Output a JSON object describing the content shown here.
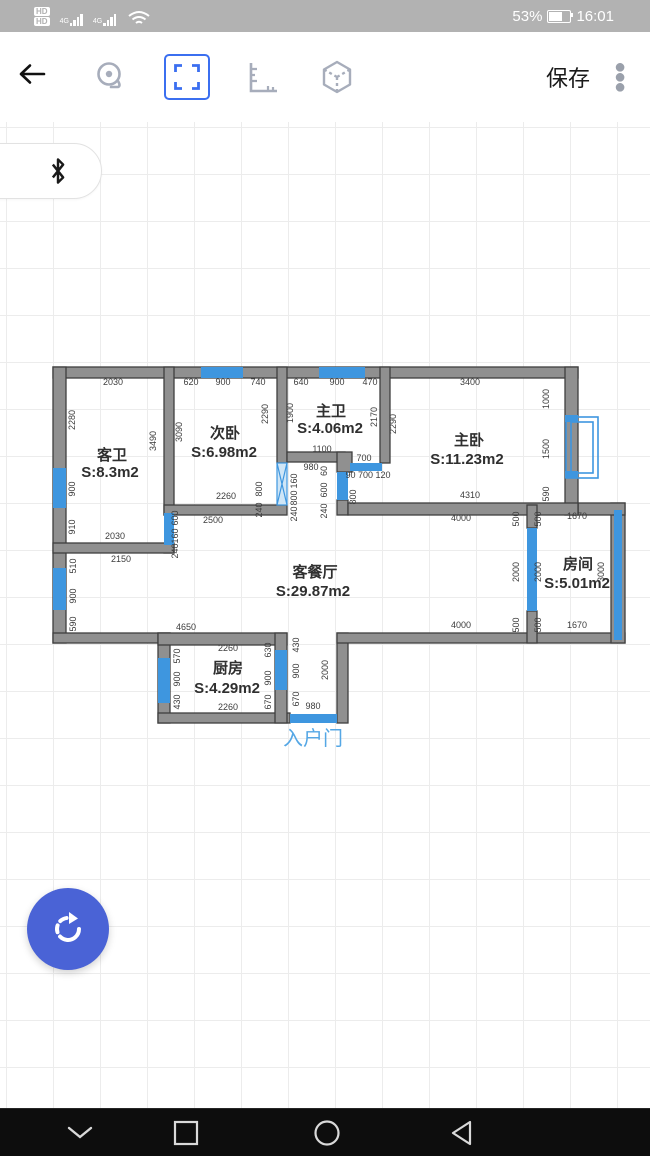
{
  "status_bar": {
    "hd_labels": [
      "HD",
      "HD"
    ],
    "network_label": "4G",
    "battery_percent": "53%",
    "time": "16:01"
  },
  "toolbar": {
    "back_icon": "arrow-left",
    "icons": [
      "measure-tape",
      "frame-select",
      "ruler",
      "cube-3d"
    ],
    "selected_icon": "frame-select",
    "save_label": "保存",
    "menu_icon": "kebab-menu"
  },
  "colors": {
    "accent_blue": "#3b6ff0",
    "window_blue": "#3e96df",
    "wall_gray": "#909090",
    "wall_stroke": "#3f3f3f",
    "fab_blue": "#4a63d6",
    "entrance_blue": "#55a7e5"
  },
  "floating": {
    "bluetooth_icon": "bluetooth"
  },
  "nav_bar": {
    "icons": [
      "chevron-down",
      "square-recents",
      "circle-home",
      "triangle-back"
    ]
  },
  "floor_plan": {
    "entrance_label": {
      "text": "入户门",
      "x": 313,
      "y": 745
    },
    "rooms": [
      {
        "name": "客卫",
        "area": "S:8.3m2",
        "nx": 112,
        "ny": 460,
        "ax": 110,
        "ay": 477
      },
      {
        "name": "次卧",
        "area": "S:6.98m2",
        "nx": 225,
        "ny": 438,
        "ax": 224,
        "ay": 457
      },
      {
        "name": "主卫",
        "area": "S:4.06m2",
        "nx": 331,
        "ny": 416,
        "ax": 330,
        "ay": 433
      },
      {
        "name": "主卧",
        "area": "S:11.23m2",
        "nx": 469,
        "ny": 445,
        "ax": 467,
        "ay": 464
      },
      {
        "name": "客餐厅",
        "area": "S:29.87m2",
        "nx": 315,
        "ny": 577,
        "ax": 313,
        "ay": 596
      },
      {
        "name": "房间",
        "area": "S:5.01m2",
        "nx": 578,
        "ny": 569,
        "ax": 577,
        "ay": 588
      },
      {
        "name": "厨房",
        "area": "S:4.29m2",
        "nx": 228,
        "ny": 673,
        "ax": 227,
        "ay": 693
      }
    ],
    "walls": [
      [
        53,
        367,
        525,
        11
      ],
      [
        53,
        367,
        13,
        276
      ],
      [
        53,
        633,
        117,
        10
      ],
      [
        158,
        633,
        12,
        90
      ],
      [
        158,
        633,
        129,
        12
      ],
      [
        158,
        713,
        132,
        10
      ],
      [
        275,
        633,
        12,
        90
      ],
      [
        337,
        633,
        11,
        90
      ],
      [
        337,
        633,
        288,
        10
      ],
      [
        611,
        503,
        14,
        140
      ],
      [
        578,
        503,
        47,
        12
      ],
      [
        565,
        367,
        13,
        148
      ],
      [
        164,
        367,
        10,
        148
      ],
      [
        164,
        545,
        10,
        8
      ],
      [
        53,
        543,
        121,
        10
      ],
      [
        164,
        505,
        123,
        10
      ],
      [
        277,
        367,
        10,
        96
      ],
      [
        287,
        452,
        58,
        10
      ],
      [
        337,
        452,
        15,
        20
      ],
      [
        380,
        367,
        10,
        96
      ],
      [
        337,
        500,
        11,
        15
      ],
      [
        348,
        503,
        230,
        12
      ],
      [
        527,
        505,
        10,
        23
      ],
      [
        527,
        611,
        10,
        32
      ]
    ],
    "windows": [
      [
        201,
        367,
        42,
        11
      ],
      [
        319,
        367,
        46,
        11
      ],
      [
        53,
        468,
        13,
        40
      ],
      [
        53,
        568,
        13,
        42
      ],
      [
        158,
        658,
        12,
        45
      ],
      [
        275,
        650,
        12,
        40
      ],
      [
        614,
        510,
        8,
        130
      ],
      [
        527,
        528,
        10,
        83
      ],
      [
        290,
        714,
        47,
        9
      ],
      [
        164,
        513,
        10,
        32
      ],
      [
        337,
        472,
        11,
        28
      ],
      [
        350,
        463,
        32,
        8
      ],
      [
        565,
        415,
        13,
        7
      ],
      [
        565,
        471,
        13,
        7
      ]
    ],
    "x_door": [
      277,
      463,
      10,
      42
    ],
    "bay_window": {
      "outer": [
        566,
        417,
        32,
        61
      ],
      "inner": [
        571,
        422,
        22,
        51
      ]
    },
    "dims": [
      {
        "t": "2030",
        "x": 113,
        "y": 385
      },
      {
        "t": "620",
        "x": 191,
        "y": 385
      },
      {
        "t": "900",
        "x": 223,
        "y": 385
      },
      {
        "t": "740",
        "x": 258,
        "y": 385
      },
      {
        "t": "640",
        "x": 301,
        "y": 385
      },
      {
        "t": "900",
        "x": 337,
        "y": 385
      },
      {
        "t": "470",
        "x": 370,
        "y": 385
      },
      {
        "t": "3400",
        "x": 470,
        "y": 385
      },
      {
        "t": "1000",
        "x": 549,
        "y": 399,
        "r": 1
      },
      {
        "t": "1500",
        "x": 549,
        "y": 449,
        "r": 1
      },
      {
        "t": "590",
        "x": 549,
        "y": 494,
        "r": 1
      },
      {
        "t": "2280",
        "x": 75,
        "y": 420,
        "r": 1
      },
      {
        "t": "900",
        "x": 75,
        "y": 489,
        "r": 1
      },
      {
        "t": "910",
        "x": 75,
        "y": 527,
        "r": 1
      },
      {
        "t": "3490",
        "x": 156,
        "y": 441,
        "r": 1
      },
      {
        "t": "3090",
        "x": 182,
        "y": 432,
        "r": 1
      },
      {
        "t": "2290",
        "x": 268,
        "y": 414,
        "r": 1
      },
      {
        "t": "1900",
        "x": 293,
        "y": 413,
        "r": 1
      },
      {
        "t": "2170",
        "x": 377,
        "y": 417,
        "r": 1
      },
      {
        "t": "2290",
        "x": 396,
        "y": 424,
        "r": 1
      },
      {
        "t": "2260",
        "x": 226,
        "y": 499
      },
      {
        "t": "2030",
        "x": 115,
        "y": 539
      },
      {
        "t": "2500",
        "x": 213,
        "y": 523
      },
      {
        "t": "2150",
        "x": 121,
        "y": 562
      },
      {
        "t": "4310",
        "x": 470,
        "y": 498
      },
      {
        "t": "4000",
        "x": 461,
        "y": 521
      },
      {
        "t": "1100",
        "x": 322,
        "y": 452
      },
      {
        "t": "980",
        "x": 311,
        "y": 470
      },
      {
        "t": "700",
        "x": 364,
        "y": 461
      },
      {
        "t": "90 700 120",
        "x": 368,
        "y": 478
      },
      {
        "t": "160",
        "x": 297,
        "y": 481,
        "r": 1
      },
      {
        "t": "800",
        "x": 297,
        "y": 498,
        "r": 1
      },
      {
        "t": "240",
        "x": 297,
        "y": 514,
        "r": 1
      },
      {
        "t": "60",
        "x": 327,
        "y": 471,
        "r": 1
      },
      {
        "t": "600",
        "x": 327,
        "y": 490,
        "r": 1
      },
      {
        "t": "240",
        "x": 327,
        "y": 511,
        "r": 1
      },
      {
        "t": "600",
        "x": 178,
        "y": 518,
        "r": 1
      },
      {
        "t": "160",
        "x": 178,
        "y": 536,
        "r": 1
      },
      {
        "t": "240",
        "x": 178,
        "y": 551,
        "r": 1
      },
      {
        "t": "800",
        "x": 262,
        "y": 489,
        "r": 1
      },
      {
        "t": "240",
        "x": 262,
        "y": 510,
        "r": 1
      },
      {
        "t": "800",
        "x": 356,
        "y": 497,
        "r": 1
      },
      {
        "t": "510",
        "x": 76,
        "y": 566,
        "r": 1
      },
      {
        "t": "900",
        "x": 76,
        "y": 596,
        "r": 1
      },
      {
        "t": "590",
        "x": 76,
        "y": 624,
        "r": 1
      },
      {
        "t": "4650",
        "x": 186,
        "y": 630
      },
      {
        "t": "4000",
        "x": 461,
        "y": 628
      },
      {
        "t": "1670",
        "x": 577,
        "y": 519
      },
      {
        "t": "1670",
        "x": 577,
        "y": 628
      },
      {
        "t": "500",
        "x": 519,
        "y": 519,
        "r": 1
      },
      {
        "t": "2000",
        "x": 519,
        "y": 572,
        "r": 1
      },
      {
        "t": "500",
        "x": 519,
        "y": 625,
        "r": 1
      },
      {
        "t": "500",
        "x": 541,
        "y": 519,
        "r": 1
      },
      {
        "t": "2000",
        "x": 541,
        "y": 572,
        "r": 1
      },
      {
        "t": "500",
        "x": 541,
        "y": 625,
        "r": 1
      },
      {
        "t": "3000",
        "x": 604,
        "y": 572,
        "r": 1
      },
      {
        "t": "2260",
        "x": 228,
        "y": 651
      },
      {
        "t": "2260",
        "x": 228,
        "y": 710
      },
      {
        "t": "570",
        "x": 180,
        "y": 656,
        "r": 1
      },
      {
        "t": "900",
        "x": 180,
        "y": 679,
        "r": 1
      },
      {
        "t": "430",
        "x": 180,
        "y": 702,
        "r": 1
      },
      {
        "t": "630",
        "x": 271,
        "y": 650,
        "r": 1
      },
      {
        "t": "900",
        "x": 271,
        "y": 678,
        "r": 1
      },
      {
        "t": "670",
        "x": 271,
        "y": 702,
        "r": 1
      },
      {
        "t": "430",
        "x": 299,
        "y": 645,
        "r": 1
      },
      {
        "t": "900",
        "x": 299,
        "y": 671,
        "r": 1
      },
      {
        "t": "670",
        "x": 299,
        "y": 699,
        "r": 1
      },
      {
        "t": "980",
        "x": 313,
        "y": 709
      },
      {
        "t": "2000",
        "x": 328,
        "y": 670,
        "r": 1
      }
    ]
  }
}
